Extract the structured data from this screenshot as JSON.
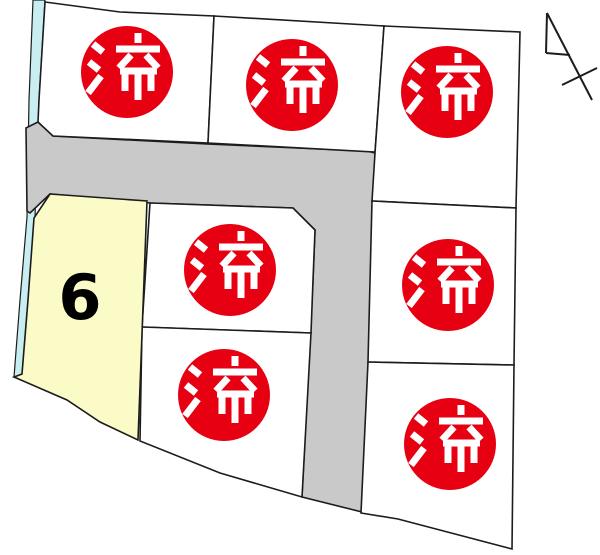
{
  "map": {
    "type": "land-lot-subdivision-map",
    "available_lot": {
      "number": "6",
      "status": "available"
    },
    "sold_stamp_label": "済",
    "lots": [
      {
        "name": "top-left",
        "status": "sold",
        "label": "済"
      },
      {
        "name": "top-middle",
        "status": "sold",
        "label": "済"
      },
      {
        "name": "top-right",
        "status": "sold",
        "label": "済"
      },
      {
        "name": "middle-center",
        "status": "sold",
        "label": "済"
      },
      {
        "name": "lower-center",
        "status": "sold",
        "label": "済"
      },
      {
        "name": "right-upper",
        "status": "sold",
        "label": "済"
      },
      {
        "name": "right-lower",
        "status": "sold",
        "label": "済"
      },
      {
        "name": "left-available",
        "status": "available",
        "label": "6"
      }
    ]
  },
  "icons": {
    "compass": "north-arrow-icon"
  },
  "colors": {
    "background": "#ffffff",
    "parcel_fill": "#ffffff",
    "road_fill": "#c9c9c9",
    "available_fill": "#fbfbc8",
    "waterway_fill": "#c9eef2",
    "stamp_red": "#e60012",
    "stamp_text": "#ffffff",
    "line": "#1c1c1c",
    "lot_number_color": "#000000"
  }
}
